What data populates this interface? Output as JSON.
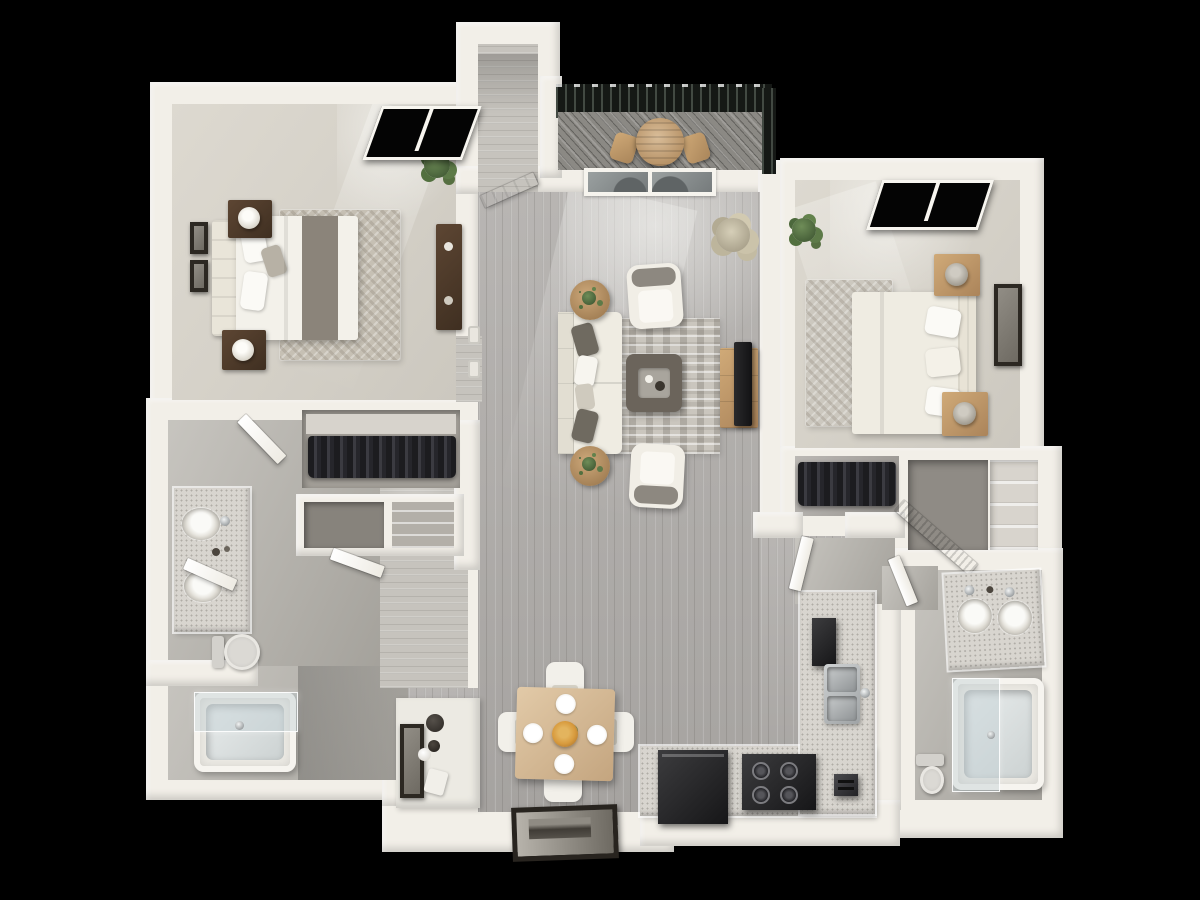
{
  "scene": {
    "title": "3D top-down floor plan render — 2 bedroom, 2 bathroom apartment with balcony",
    "canvas": {
      "width": 1200,
      "height": 900
    },
    "background": "#000000"
  },
  "palette": {
    "bg": "#000000",
    "wall": "#f2efe8",
    "wall-edge": "#d8d3c9",
    "carpet": "#d6d2c9",
    "tile": "#b7b4ad",
    "wood": "#b0adaa",
    "wood-light": "#c6c3bd",
    "deck": "#8b8984",
    "railing": "#151815",
    "window-frame": "#f8f6f0",
    "glass": "#8f9394",
    "bed-white": "#f3f1ea",
    "runner": "#8b847a",
    "walnut": "#4e3a2b",
    "oak": "#c59e6c",
    "tan": "#d9bd99",
    "sofa": "#efece2",
    "pillow-dark": "#6f6a60",
    "table-dark": "#6b645b",
    "tv-black": "#1b1b1d",
    "counter-top": "#d8d5cf",
    "counter-face": "#edebe5",
    "appliance-black": "#232325",
    "steel": "#b9bcbe",
    "tub": "#eceae4",
    "tub-glass": "rgba(196,208,212,0.45)",
    "toilet": "#d9d7d2",
    "plant-green": "#5d7a48",
    "plant-dry": "#c9c0a8",
    "clothes-dark": "#232326",
    "frame-dark": "#2c2822",
    "flower-orange": "#d89b3e",
    "rug-bedroom": "#c6c0b4",
    "rug-living": "#cac6be"
  },
  "floorplan": {
    "unit": {
      "bedrooms": 2,
      "bathrooms": 2,
      "balcony": true
    },
    "rooms": [
      {
        "id": "bedroom-1",
        "floor": "carpet",
        "furniture": [
          "queen-bed",
          "headboard",
          "nightstand-x2",
          "table-lamp-x2",
          "dresser",
          "area-rug",
          "wall-art-x2",
          "corner-plant",
          "window"
        ]
      },
      {
        "id": "walk-in-closet-1",
        "floor": "carpet",
        "furniture": [
          "hanging-clothes",
          "shelf",
          "storage-cubbies"
        ]
      },
      {
        "id": "bathroom-1",
        "floor": "tile",
        "furniture": [
          "double-vanity",
          "sink-x2",
          "toilet",
          "bathtub",
          "glass-door"
        ]
      },
      {
        "id": "hallway",
        "floor": "wood",
        "furniture": [
          "light-switches"
        ]
      },
      {
        "id": "living-room",
        "floor": "wood",
        "furniture": [
          "sofa",
          "throw-pillows",
          "armchair-x2",
          "coffee-table",
          "tray-with-cups",
          "area-rug",
          "side-table-x2",
          "tv-console",
          "tv",
          "dried-floor-plant",
          "sliding-glass-door"
        ]
      },
      {
        "id": "balcony",
        "floor": "deck",
        "furniture": [
          "round-table",
          "chairs",
          "railing",
          "pergola"
        ]
      },
      {
        "id": "entry",
        "floor": "wood",
        "furniture": [
          "front-door"
        ]
      },
      {
        "id": "dining-area",
        "floor": "wood",
        "furniture": [
          "square-table",
          "chair-x4",
          "place-setting-x4",
          "flower-centerpiece",
          "leaning-wall-art"
        ]
      },
      {
        "id": "desk-nook",
        "floor": "wood",
        "furniture": [
          "counter",
          "picture-frames",
          "accessories"
        ]
      },
      {
        "id": "kitchen",
        "floor": "wood",
        "furniture": [
          "l-shaped-counter",
          "refrigerator",
          "range",
          "double-sink",
          "toaster"
        ]
      },
      {
        "id": "bedroom-2",
        "floor": "carpet",
        "furniture": [
          "queen-bed",
          "nightstand-x2",
          "table-lamp-x2",
          "area-rug",
          "wall-art",
          "corner-plant",
          "window"
        ]
      },
      {
        "id": "closet-2",
        "floor": "carpet",
        "furniture": [
          "hanging-clothes",
          "louvered-door"
        ]
      },
      {
        "id": "linen-closet",
        "floor": "carpet",
        "furniture": [
          "shelves"
        ]
      },
      {
        "id": "bathroom-2",
        "floor": "tile",
        "furniture": [
          "double-vanity",
          "sink-x2",
          "toilet",
          "bathtub",
          "glass-panel"
        ]
      }
    ]
  }
}
